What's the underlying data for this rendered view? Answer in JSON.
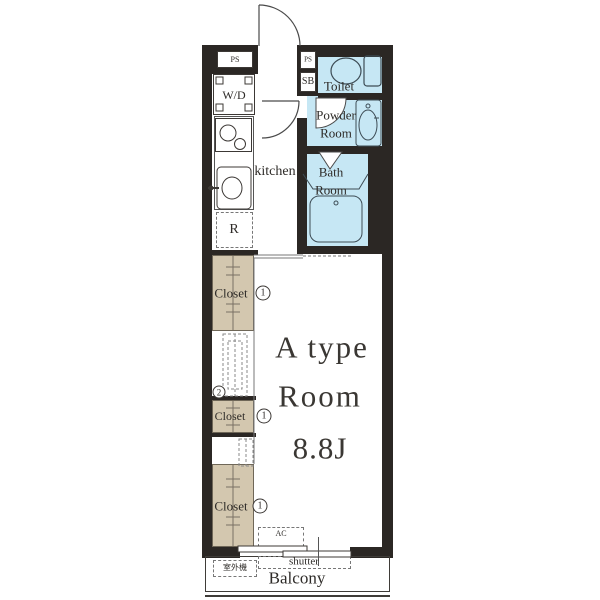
{
  "colors": {
    "wall": "#2b2724",
    "wet_area": "#c6e7f4",
    "closet": "#d3c7af",
    "text": "#2e2b28"
  },
  "rooms": {
    "toilet": {
      "label": "Toilet"
    },
    "powder_room": {
      "label_line1": "Powder",
      "label_line2": "Room"
    },
    "bath_room": {
      "label_line1": "Bath",
      "label_line2": "Room"
    },
    "kitchen": {
      "label": "kitchen"
    },
    "main_room": {
      "type_line1": "A type",
      "type_line2": "Room",
      "size": "8.8J"
    },
    "balcony": {
      "label": "Balcony"
    }
  },
  "fixtures": {
    "ps_left": "PS",
    "ps_right": "PS",
    "shoe_box": "SB",
    "washer_dryer": "W/D",
    "refrigerator": "R",
    "air_conditioner": "AC",
    "outdoor_unit": "室外機",
    "shutter": "shutter"
  },
  "closets": {
    "top": {
      "label": "Closet",
      "num": "1"
    },
    "middle": {
      "label": "Closet",
      "num": "1"
    },
    "bottom": {
      "label": "Closet",
      "num": "1"
    }
  },
  "ladder": {
    "num": "2"
  }
}
